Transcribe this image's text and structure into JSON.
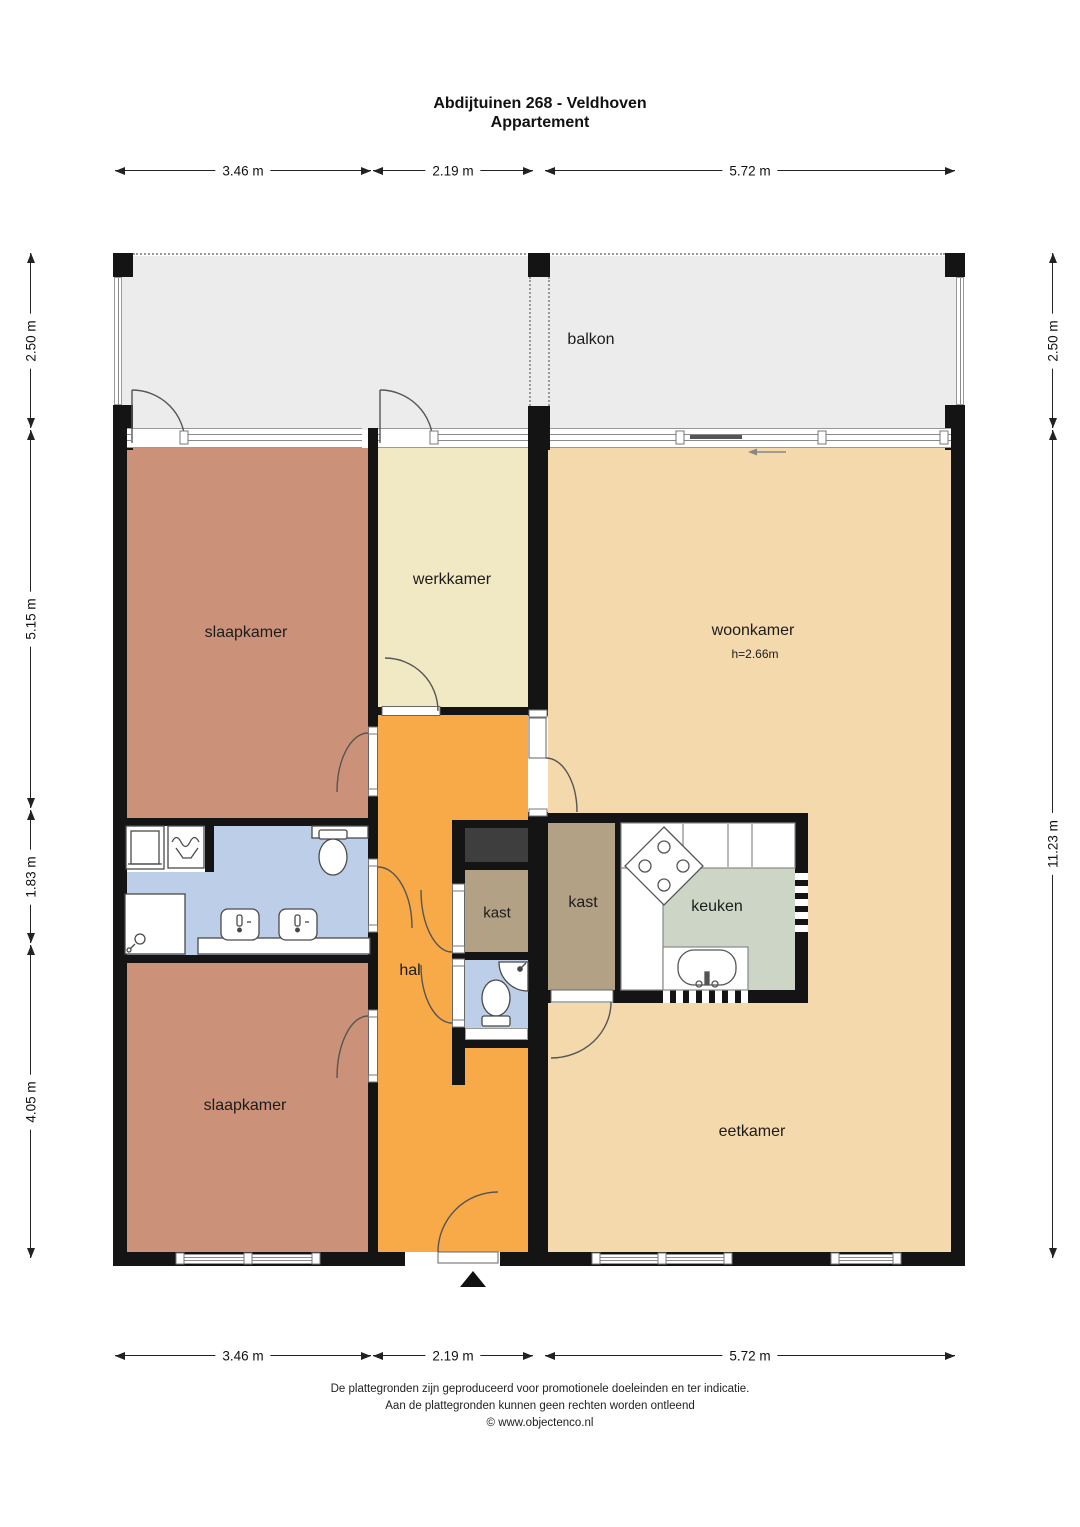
{
  "title": {
    "line1": "Abdijtuinen 268 - Veldhoven",
    "line2": "Appartement"
  },
  "rooms": {
    "balkon": "balkon",
    "slaapkamer1": "slaapkamer",
    "werkkamer": "werkkamer",
    "woonkamer": "woonkamer",
    "woonkamer_height": "h=2.66m",
    "kast1": "kast",
    "kast2": "kast",
    "keuken": "keuken",
    "hal": "hal",
    "slaapkamer2": "slaapkamer",
    "eetkamer": "eetkamer"
  },
  "dimensions": {
    "top": [
      "3.46 m",
      "2.19 m",
      "5.72 m"
    ],
    "bottom": [
      "3.46 m",
      "2.19 m",
      "5.72 m"
    ],
    "left": [
      "2.50 m",
      "5.15 m",
      "1.83 m",
      "4.05 m"
    ],
    "right": [
      "2.50 m",
      "11.23 m"
    ]
  },
  "footer": {
    "line1": "De plattegronden zijn geproduceerd voor promotionele doeleinden en ter indicatie.",
    "line2": "Aan de plattegronden kunnen geen rechten worden ontleend",
    "line3": "© www.objectenco.nl"
  },
  "colors": {
    "wall": "#141414",
    "balkon": "#ececec",
    "slaapkamer": "#cb9279",
    "werkkamer": "#f1e8c4",
    "woonkamer": "#f3d9ab",
    "hal": "#f8aa48",
    "badkamer": "#bdcfe8",
    "kast": "#b2a184",
    "keuken": "#cdd6c6",
    "shaft": "#3e3e3e"
  }
}
